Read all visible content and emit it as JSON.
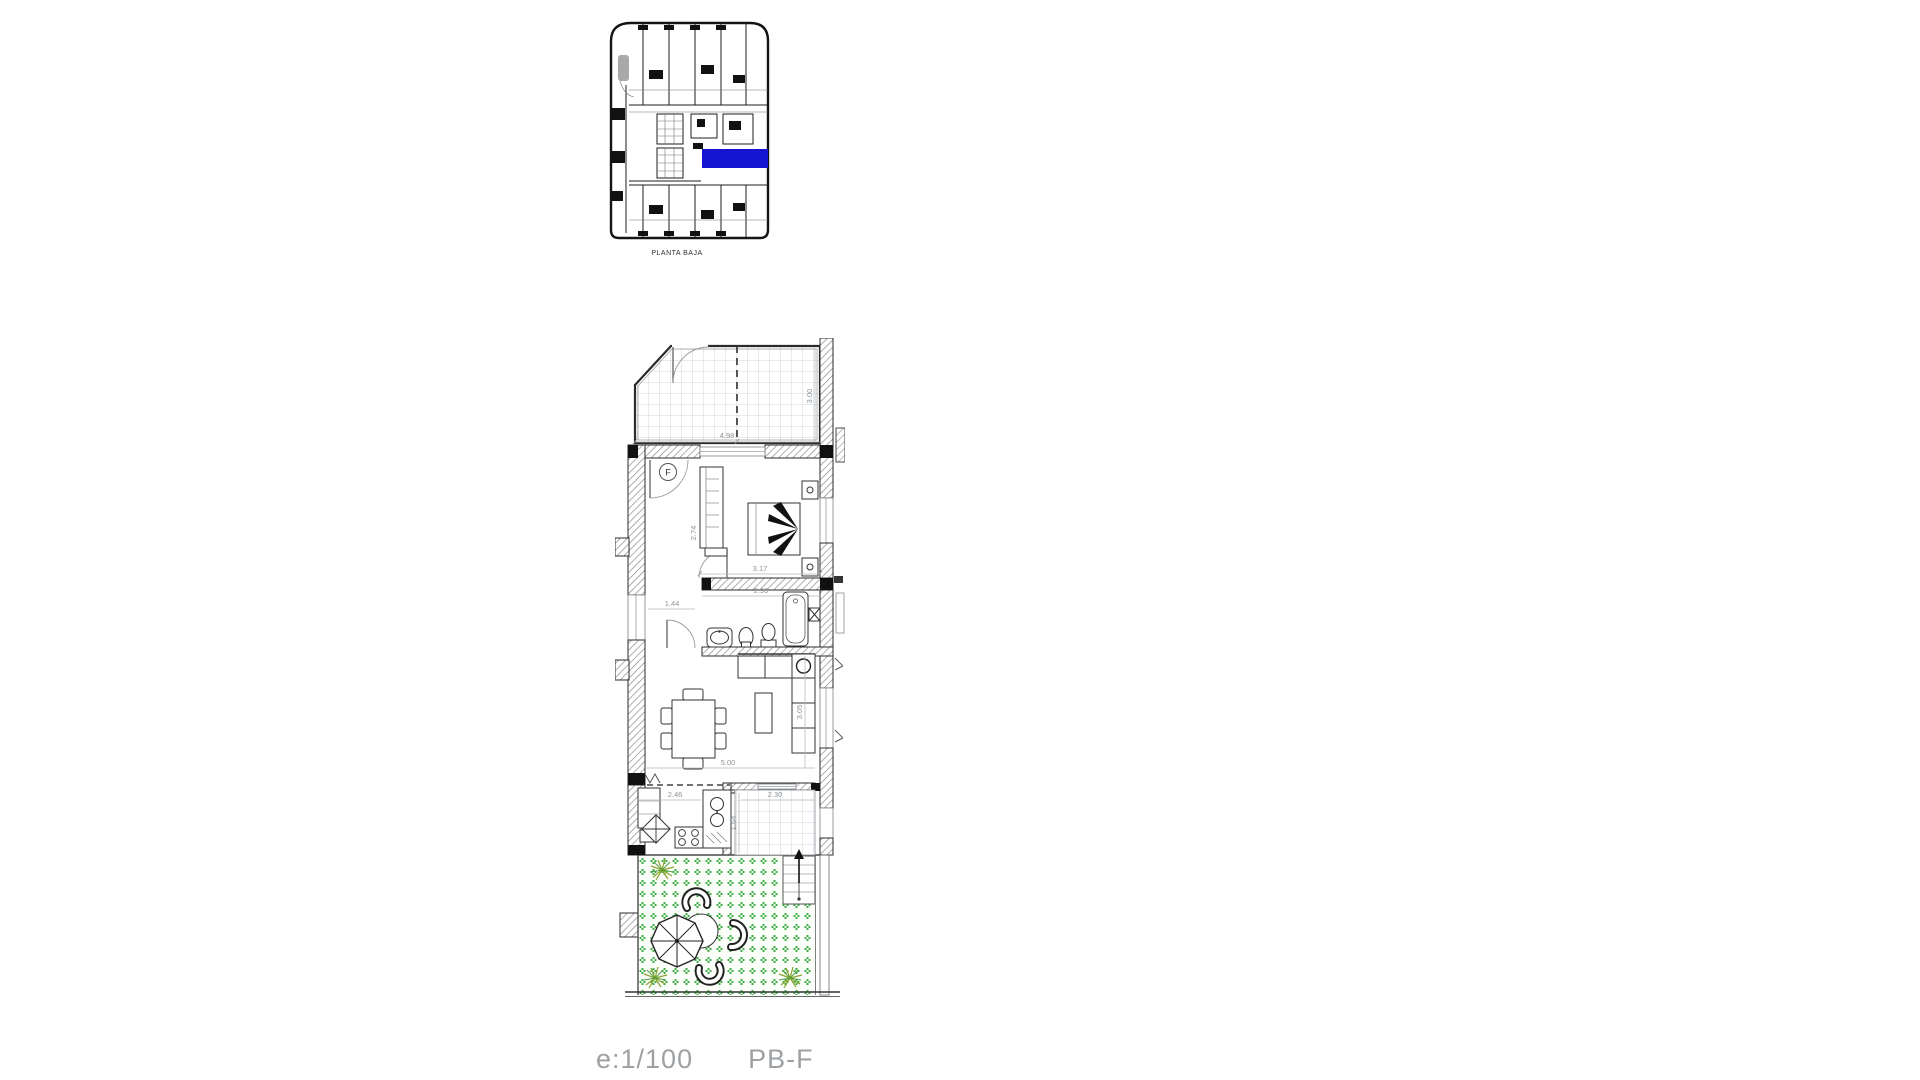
{
  "key_plan": {
    "caption": "PLANTA BAJA"
  },
  "main_plan": {
    "dims": {
      "terrace_width": "4.98",
      "terrace_depth": "3.00",
      "bedroom_width": "3.17",
      "bedroom_depth": "2.74",
      "bathroom_width": "2.90",
      "hallway_width": "1.44",
      "living_width": "5.00",
      "living_depth": "3.05",
      "kitchen_width": "2.46",
      "entry_width": "2.30",
      "entry_depth": "1.64"
    },
    "symbols": {
      "fan_coil": "F"
    }
  },
  "footer": {
    "scale": "e:1/100",
    "plan_code": "PB-F"
  },
  "colors": {
    "highlight": "#1414d2",
    "garden_dot": "#3fae46",
    "plant": "#8aa32e",
    "dim_text": "#8f9498",
    "footer_text": "#9da1a4"
  }
}
